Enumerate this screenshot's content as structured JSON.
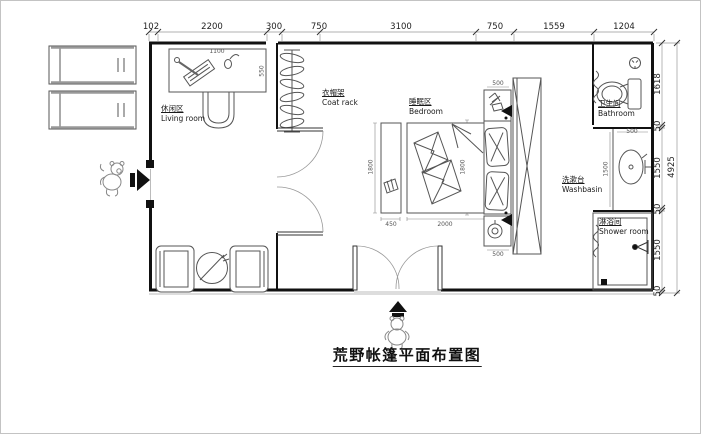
{
  "title": "荒野帐篷平面布置图",
  "rooms": {
    "living": {
      "zh": "休闲区",
      "en": "Living room"
    },
    "coat_rack": {
      "zh": "衣帽架",
      "en": "Coat rack"
    },
    "bedroom": {
      "zh": "睡眠区",
      "en": "Bedroom"
    },
    "bathroom": {
      "zh": "卫生间",
      "en": "Bathroom"
    },
    "washbasin": {
      "zh": "洗漱台",
      "en": "Washbasin"
    },
    "shower": {
      "zh": "淋浴间",
      "en": "Shower room"
    }
  },
  "dims": {
    "top": [
      "102",
      "2200",
      "300",
      "750",
      "3100",
      "750",
      "1559",
      "1204"
    ],
    "right": [
      "1618",
      "50",
      "1550",
      "50",
      "1550",
      "50"
    ],
    "right_total": "4925",
    "interior": {
      "desk_width": "1100",
      "desk_depth": "550",
      "bed_width": "2000",
      "bench_width": "450",
      "bed_length_left": "1800",
      "bed_length_mid": "1800",
      "nightstand_top": "500",
      "nightstand_bottom": "500",
      "basin_counter_height": "1500",
      "basin_width": "500"
    }
  },
  "icons": {
    "entrance_side": "solid-right-arrow",
    "entrance_front": "solid-up-arrow",
    "mascot_left": "bear-figure",
    "mascot_bottom": "bear-figure",
    "coat_rack": "pole-with-hangers",
    "toilet": "toilet-top-view",
    "ceiling_light": "circle-light",
    "washbasin": "oval-basin",
    "shower_head": "shower-sprayer",
    "floor_drain": "black-square",
    "wall_lamp": "black-sconce",
    "plant": "potted-plant-sketch",
    "table_lamp": "round-lamp",
    "keyboard": "keyboard-sketch",
    "mouse": "mouse-sketch"
  },
  "colors": {
    "wall": "#111111",
    "furniture_line": "#555555",
    "dim_line": "#888888",
    "dim_text": "#222222",
    "background": "#ffffff",
    "border": "#c3c3c3"
  }
}
